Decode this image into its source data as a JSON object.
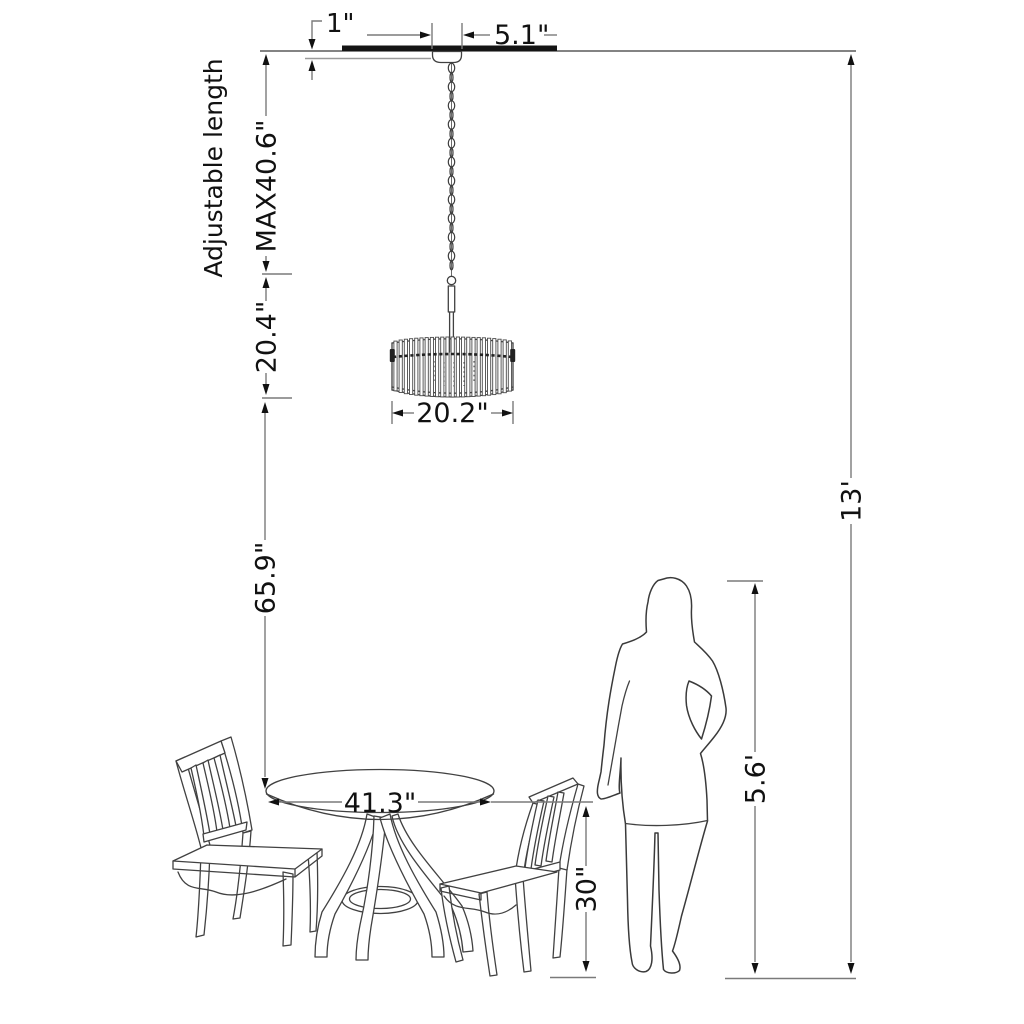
{
  "diagram": {
    "labels": {
      "adjustable_length": "Adjustable length",
      "canopy_height": "1\"",
      "canopy_width": "5.1\"",
      "max_length": "MAX40.6\"",
      "fixture_height": "20.4\"",
      "shade_diameter": "20.2\"",
      "clearance": "65.9\"",
      "ceiling_height": "13'",
      "person_height": "5.6'",
      "table_height": "30\"",
      "table_diameter": "41.3\""
    },
    "colors": {
      "background": "#ffffff",
      "dimension_line": "#7a7a7a",
      "drawing_line": "#414141",
      "text": "#111111"
    }
  }
}
